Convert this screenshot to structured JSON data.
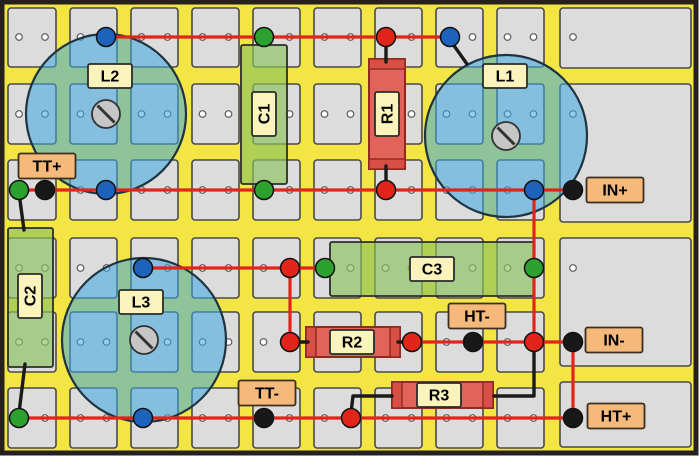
{
  "diagram_type": "stripboard-crossover-layout",
  "colors": {
    "page_bg": "#ffffff",
    "board_bg": "#f2e544",
    "board_border": "#26211c",
    "pad": "#dcdcdc",
    "pad_border": "#4a4a4a",
    "hole_fill": "#ffffff",
    "hole_border": "#5a5a5a",
    "inductor_fill": "rgba(62,168,226,0.55)",
    "inductor_border": "#1f3340",
    "screw_fill": "#c6c6c6",
    "screw_border": "#333333",
    "capacitor_fill": "rgba(140,196,94,0.66)",
    "capacitor_border": "#2d2d2d",
    "resistor_fill": "#e2635a",
    "resistor_cap": "#d84f45",
    "resistor_border": "#8e2a20",
    "trace_red": "#e1251b",
    "lead_black": "#1a1a1a",
    "label_fill": "#faf3bc",
    "label_border": "#2b2b2b",
    "io_fill": "#f5b97c",
    "io_border": "#3d2f1f",
    "dot_green": "#2da12d",
    "dot_blue": "#1d63bb",
    "dot_red": "#e1251b",
    "dot_black": "#181818",
    "dot_outline": "#111111",
    "text": "#000000"
  },
  "board": {
    "x": 2,
    "y": 2,
    "width": 694,
    "height": 451
  },
  "grid": {
    "col_spans": [
      [
        8,
        56
      ],
      [
        70,
        117
      ],
      [
        131,
        178
      ],
      [
        192,
        239
      ],
      [
        253,
        300
      ],
      [
        314,
        361
      ],
      [
        375,
        422
      ],
      [
        436,
        483
      ],
      [
        497,
        544
      ]
    ],
    "row_spans": [
      [
        8,
        67
      ],
      [
        84,
        144
      ],
      [
        160,
        220
      ],
      [
        238,
        298
      ],
      [
        312,
        372
      ],
      [
        388,
        448
      ]
    ],
    "hole_rows_y": [
      37,
      114,
      190,
      268,
      342,
      418
    ],
    "hole_dx": 13,
    "wide_col_span": [
      560,
      691
    ],
    "wide_pad_rows": [
      [
        8,
        68
      ],
      [
        84,
        222
      ],
      [
        238,
        366
      ],
      [
        382,
        447
      ]
    ],
    "wide_hole_x": 573
  },
  "components": {
    "inductors": [
      {
        "ref": "L1",
        "cx": 506,
        "cy": 136,
        "r": 81,
        "screw_r": 14,
        "label": {
          "text": "L1",
          "x": 505,
          "y": 76,
          "rotated": false
        }
      },
      {
        "ref": "L2",
        "cx": 106,
        "cy": 114,
        "r": 80,
        "screw_r": 14,
        "label": {
          "text": "L2",
          "x": 110,
          "y": 76,
          "rotated": false
        }
      },
      {
        "ref": "L3",
        "cx": 144,
        "cy": 340,
        "r": 82,
        "screw_r": 14,
        "label": {
          "text": "L3",
          "x": 141,
          "y": 302,
          "rotated": false
        }
      }
    ],
    "capacitors": [
      {
        "ref": "C1",
        "x": 241,
        "y": 45,
        "w": 46,
        "h": 139,
        "label": {
          "text": "C1",
          "x": 264,
          "y": 114,
          "rotated": true
        }
      },
      {
        "ref": "C2",
        "x": 8,
        "y": 228,
        "w": 45,
        "h": 139,
        "label": {
          "text": "C2",
          "x": 30,
          "y": 296,
          "rotated": true
        }
      },
      {
        "ref": "C3",
        "x": 330,
        "y": 242,
        "w": 204,
        "h": 54,
        "label": {
          "text": "C3",
          "x": 432,
          "y": 269,
          "rotated": false
        }
      }
    ],
    "resistors": [
      {
        "ref": "R1",
        "x": 369,
        "y": 59,
        "w": 36,
        "h": 110,
        "label": {
          "text": "R1",
          "x": 387,
          "y": 114,
          "rotated": true
        }
      },
      {
        "ref": "R2",
        "x": 306,
        "y": 327,
        "w": 94,
        "h": 30,
        "label": {
          "text": "R2",
          "x": 352,
          "y": 342,
          "rotated": false
        }
      },
      {
        "ref": "R3",
        "x": 392,
        "y": 382,
        "w": 101,
        "h": 26,
        "label": {
          "text": "R3",
          "x": 439,
          "y": 395,
          "rotated": false
        }
      }
    ]
  },
  "io_labels": [
    {
      "id": "tt-plus",
      "text": "TT+",
      "x": 47,
      "y": 166
    },
    {
      "id": "in-plus",
      "text": "IN+",
      "x": 615,
      "y": 190
    },
    {
      "id": "ht-minus",
      "text": "HT-",
      "x": 477,
      "y": 316
    },
    {
      "id": "in-minus",
      "text": "IN-",
      "x": 614,
      "y": 340
    },
    {
      "id": "tt-minus",
      "text": "TT-",
      "x": 267,
      "y": 393
    },
    {
      "id": "ht-plus",
      "text": "HT+",
      "x": 616,
      "y": 416
    }
  ],
  "terminals": [
    {
      "color": "blue",
      "x": 106,
      "y": 37
    },
    {
      "color": "green",
      "x": 264,
      "y": 37
    },
    {
      "color": "red",
      "x": 386,
      "y": 37
    },
    {
      "color": "blue",
      "x": 450,
      "y": 37
    },
    {
      "color": "green",
      "x": 19,
      "y": 190
    },
    {
      "color": "black",
      "x": 45,
      "y": 190
    },
    {
      "color": "blue",
      "x": 106,
      "y": 190
    },
    {
      "color": "green",
      "x": 264,
      "y": 190
    },
    {
      "color": "red",
      "x": 386,
      "y": 190
    },
    {
      "color": "blue",
      "x": 534,
      "y": 190
    },
    {
      "color": "black",
      "x": 573,
      "y": 190
    },
    {
      "color": "blue",
      "x": 143,
      "y": 268
    },
    {
      "color": "red",
      "x": 290,
      "y": 268
    },
    {
      "color": "green",
      "x": 325,
      "y": 268
    },
    {
      "color": "green",
      "x": 534,
      "y": 268
    },
    {
      "color": "red",
      "x": 290,
      "y": 342
    },
    {
      "color": "red",
      "x": 412,
      "y": 342
    },
    {
      "color": "black",
      "x": 473,
      "y": 342
    },
    {
      "color": "red",
      "x": 534,
      "y": 342
    },
    {
      "color": "black",
      "x": 573,
      "y": 342
    },
    {
      "color": "green",
      "x": 19,
      "y": 418
    },
    {
      "color": "blue",
      "x": 143,
      "y": 418
    },
    {
      "color": "black",
      "x": 264,
      "y": 418
    },
    {
      "color": "red",
      "x": 351,
      "y": 418
    },
    {
      "color": "black",
      "x": 573,
      "y": 418
    }
  ],
  "wires": {
    "red": [
      [
        [
          106,
          37
        ],
        [
          450,
          37
        ]
      ],
      [
        [
          19,
          190
        ],
        [
          573,
          190
        ]
      ],
      [
        [
          534,
          190
        ],
        [
          534,
          342
        ]
      ],
      [
        [
          143,
          268
        ],
        [
          325,
          268
        ]
      ],
      [
        [
          290,
          268
        ],
        [
          290,
          342
        ]
      ],
      [
        [
          412,
          342
        ],
        [
          573,
          342
        ]
      ],
      [
        [
          573,
          342
        ],
        [
          573,
          418
        ]
      ],
      [
        [
          19,
          418
        ],
        [
          573,
          418
        ]
      ]
    ],
    "black": [
      [
        [
          19,
          193
        ],
        [
          24,
          230
        ]
      ],
      [
        [
          25,
          364
        ],
        [
          19,
          413
        ]
      ],
      [
        [
          450,
          40
        ],
        [
          467,
          64
        ]
      ],
      [
        [
          386,
          40
        ],
        [
          386,
          62
        ]
      ],
      [
        [
          386,
          166
        ],
        [
          386,
          188
        ]
      ],
      [
        [
          292,
          342
        ],
        [
          308,
          342
        ]
      ],
      [
        [
          398,
          342
        ],
        [
          410,
          342
        ]
      ],
      [
        [
          534,
          345
        ],
        [
          534,
          396
        ],
        [
          494,
          396
        ]
      ],
      [
        [
          392,
          396
        ],
        [
          353,
          396
        ],
        [
          351,
          413
        ]
      ]
    ]
  }
}
